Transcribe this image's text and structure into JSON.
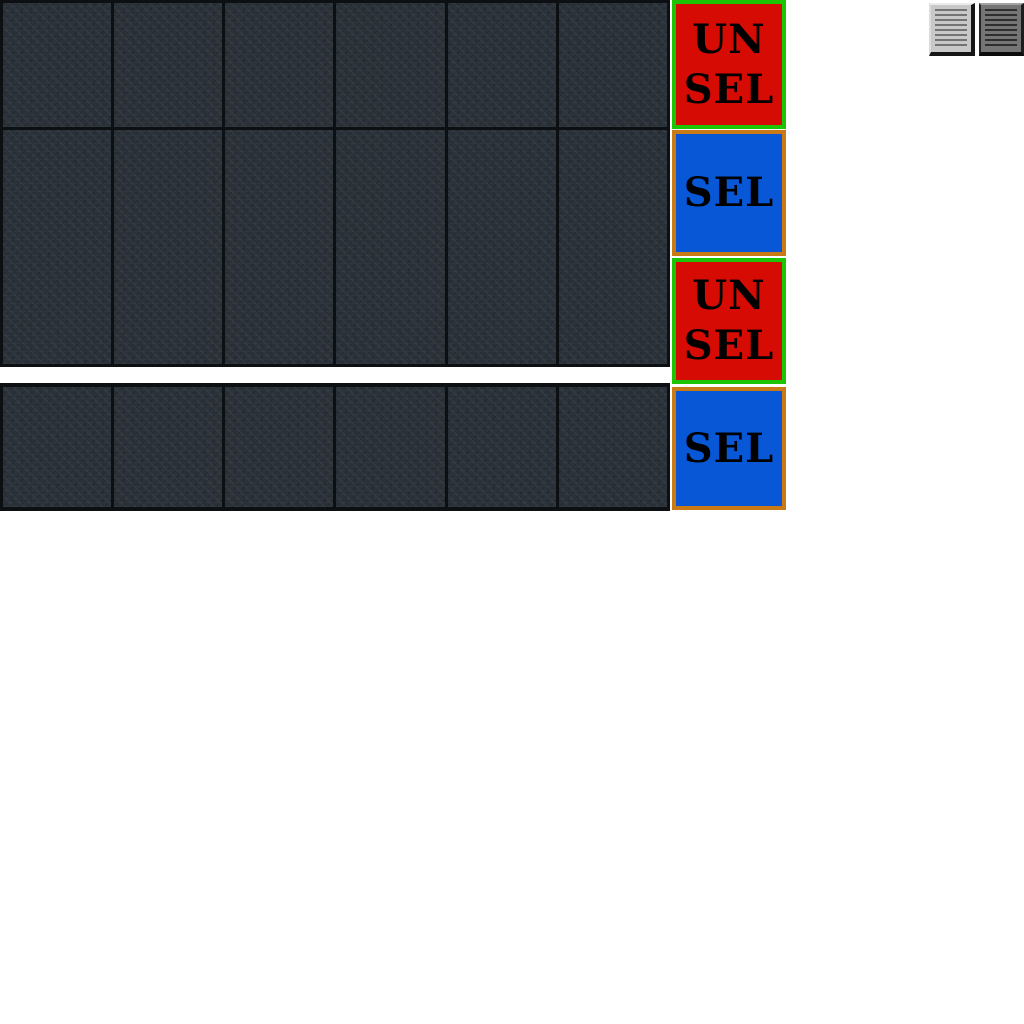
{
  "app": {
    "background": "#ffffff"
  },
  "tile_grid": {
    "columns": 6,
    "tile_texture_base_color": "#2a3138",
    "grid_line_color": "#0d1013",
    "blocks": [
      {
        "id": "row-1",
        "tiles": 6
      },
      {
        "id": "rows-2-3",
        "tiles": 6
      },
      {
        "id": "row-4",
        "tiles": 6
      }
    ]
  },
  "selection_buttons": [
    {
      "id": "row-1-toggle",
      "state": "unselected",
      "line1": "UN",
      "line2": "SEL",
      "fill": "#d60b04",
      "border": "#1dc404"
    },
    {
      "id": "row-2-toggle",
      "state": "selected",
      "line1": "SEL",
      "fill": "#0757d6",
      "border": "#ca7a14"
    },
    {
      "id": "row-3-toggle",
      "state": "unselected",
      "line1": "UN",
      "line2": "SEL",
      "fill": "#d60b04",
      "border": "#1dc404"
    },
    {
      "id": "row-4-toggle",
      "state": "selected",
      "line1": "SEL",
      "fill": "#0757d6",
      "border": "#ca7a14"
    }
  ],
  "toolbar": {
    "icons": [
      {
        "id": "lined-page-light-icon",
        "appearance": "light-raised"
      },
      {
        "id": "lined-page-dark-icon",
        "appearance": "dark"
      }
    ]
  }
}
